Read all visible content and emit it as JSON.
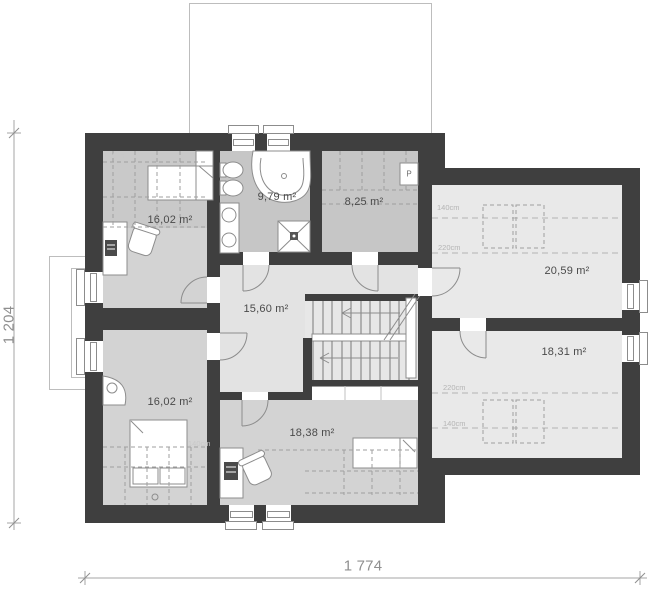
{
  "plan": {
    "rooms": {
      "bedroom_top": "16,02 m²",
      "bathroom": "9,79 m²",
      "wardrobe_room": "8,25 m²",
      "hall": "15,60 m²",
      "attic_top": "20,59 m²",
      "attic_bottom": "18,31 m²",
      "bedroom_bottom": "16,02 m²",
      "study_room": "18,38 m²"
    },
    "height_marks": {
      "attic_top_140": "140cm",
      "attic_top_220": "220cm",
      "attic_bottom_220": "220cm",
      "attic_bottom_140": "140cm",
      "bedroom_top_140": "140cm",
      "bedroom_bottom_140": "140cm"
    },
    "appliance": {
      "washer": "P"
    },
    "dimensions": {
      "width": "1 774",
      "height": "1 204"
    },
    "colors": {
      "wall": "#3f3f3f",
      "room_light": "#d3d3d3",
      "room_dark": "#c6c6c6",
      "hall": "#e3e3e3",
      "attic_room": "#e9e9e9"
    }
  }
}
